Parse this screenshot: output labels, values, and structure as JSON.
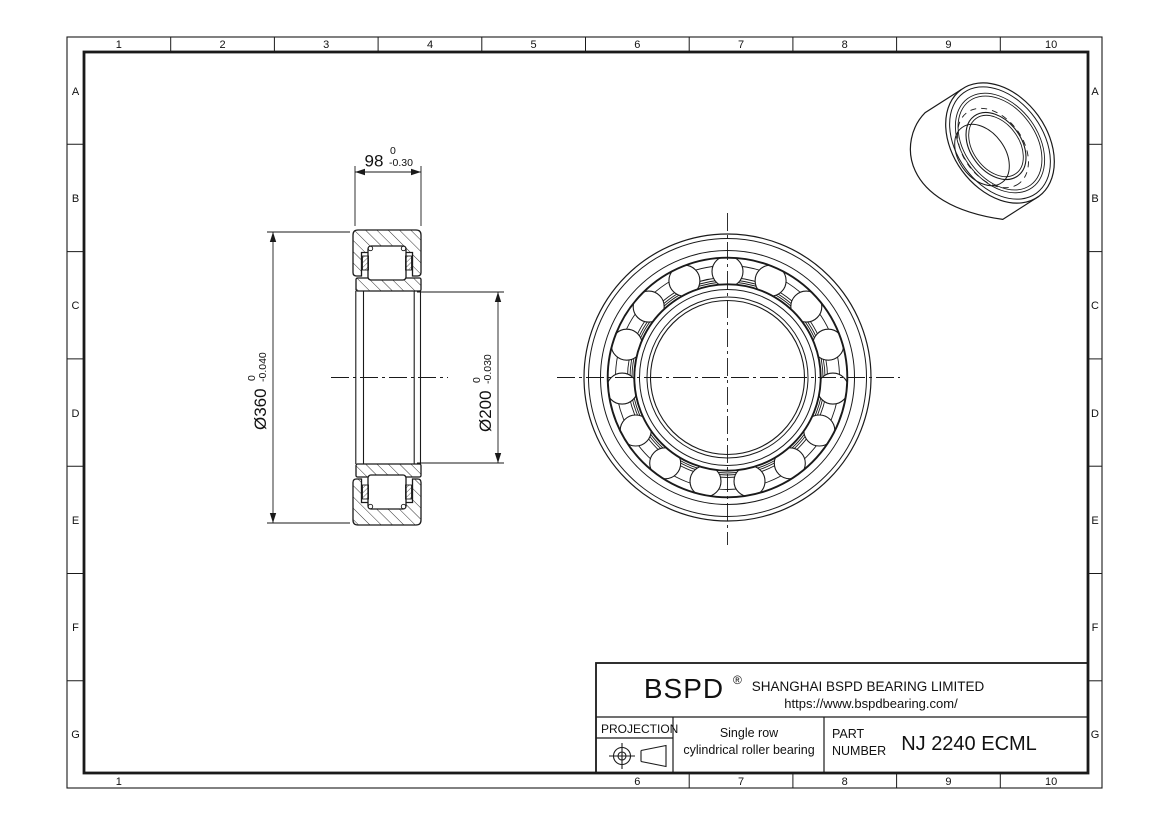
{
  "drawing_frame": {
    "top_labels": [
      "1",
      "2",
      "3",
      "4",
      "5",
      "6",
      "7",
      "8",
      "9",
      "10"
    ],
    "bottom_labels": [
      "1",
      "6",
      "7",
      "8",
      "9",
      "10"
    ],
    "left_labels": [
      "A",
      "B",
      "C",
      "D",
      "E",
      "F",
      "G"
    ],
    "right_labels": [
      "A",
      "B",
      "C",
      "D",
      "E",
      "F",
      "G"
    ]
  },
  "dimensions": {
    "width": {
      "value": "98",
      "tol_upper": "0",
      "tol_lower": "-0.30"
    },
    "outer_diameter": {
      "value": "Ø360",
      "tol_upper": "0",
      "tol_lower": "-0.040"
    },
    "bore": {
      "value": "Ø200",
      "tol_upper": "0",
      "tol_lower": "-0.030"
    }
  },
  "title_block": {
    "brand": "BSPD",
    "registered_mark": "®",
    "company": "SHANGHAI BSPD BEARING LIMITED",
    "website": "https://www.bspdbearing.com/",
    "projection_label": "PROJECTION",
    "projection_icon": "first-angle-projection-symbol",
    "description_line1": "Single row",
    "description_line2": "cylindrical roller bearing",
    "part_label_line1": "PART",
    "part_label_line2": "NUMBER",
    "part_number": "NJ 2240 ECML"
  },
  "line_color": "#1a1a1a"
}
